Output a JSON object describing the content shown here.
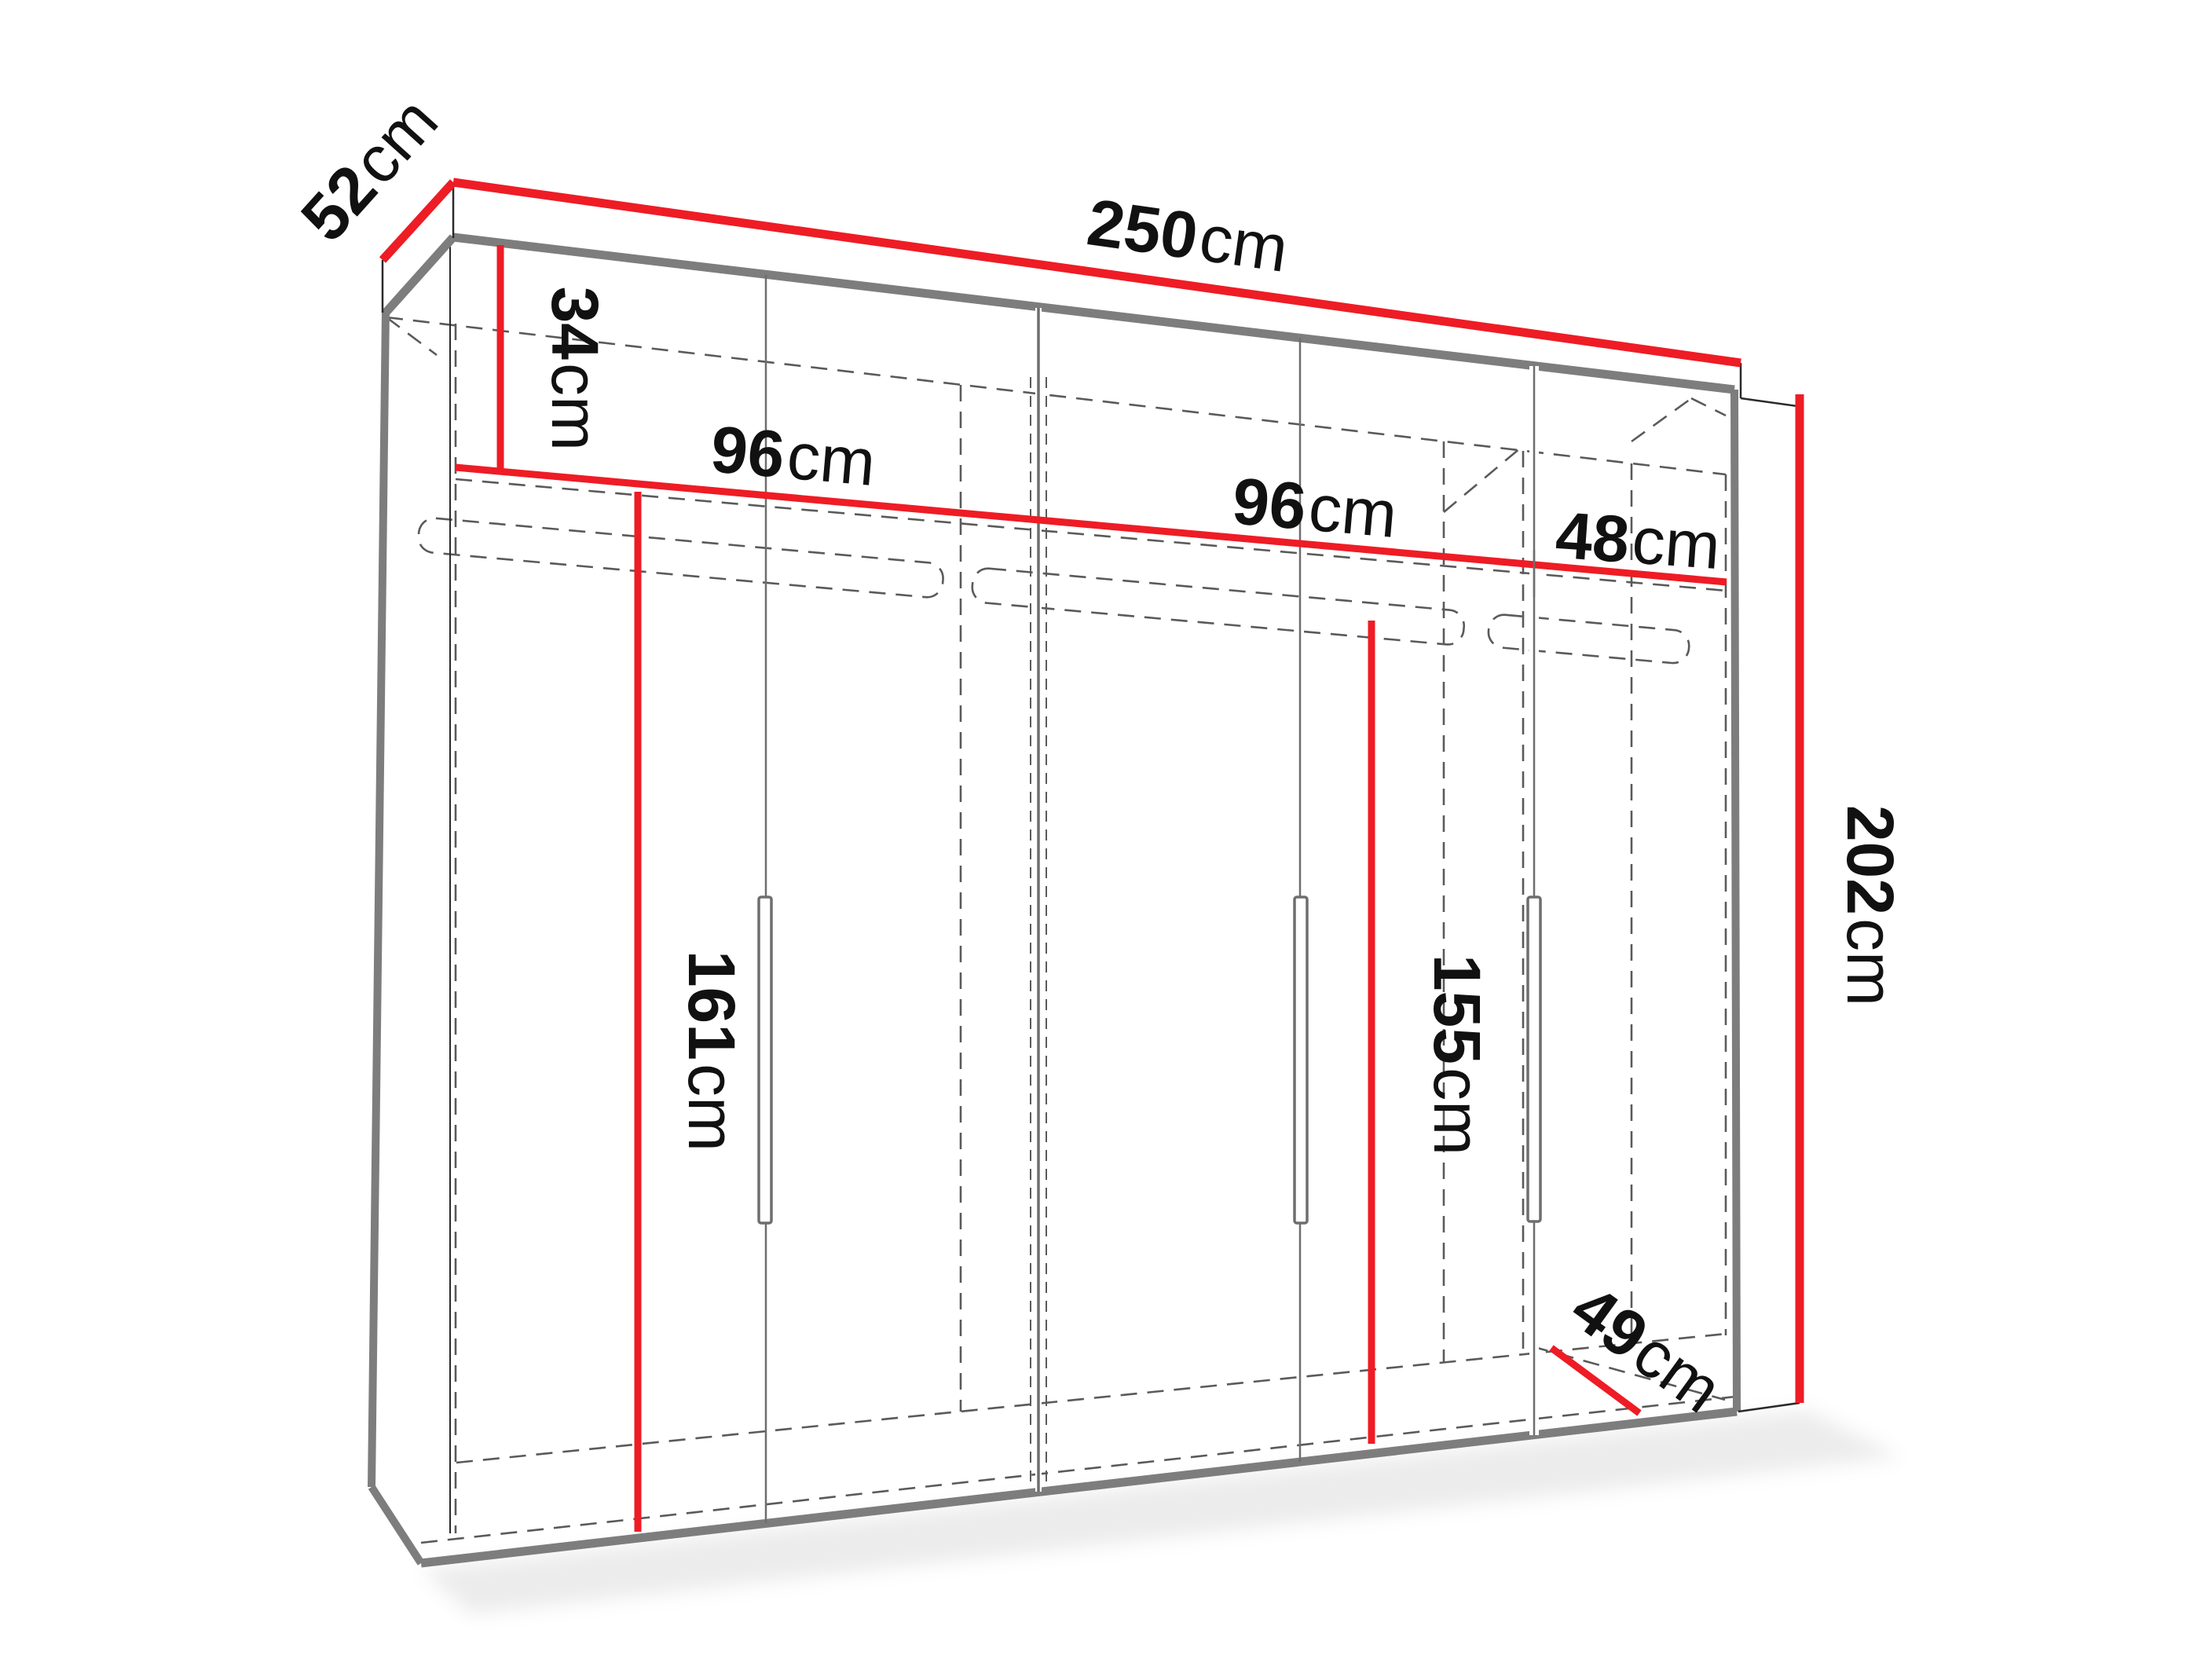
{
  "diagram": {
    "title": "wardrobe-dimension-drawing",
    "unit": "cm",
    "colors": {
      "dimension_line": "#ee1c25",
      "structure_edge": "#7d7d7d",
      "dashed_interior": "#5a5a5a",
      "label_text": "#111111",
      "background": "#ffffff"
    },
    "dims": {
      "width": {
        "v": "250",
        "u": "cm"
      },
      "depth": {
        "v": "52",
        "u": "cm"
      },
      "height": {
        "v": "202",
        "u": "cm"
      },
      "top_shelf": {
        "v": "34",
        "u": "cm"
      },
      "left_section": {
        "v": "96",
        "u": "cm"
      },
      "mid_section": {
        "v": "96",
        "u": "cm"
      },
      "right_section": {
        "v": "48",
        "u": "cm"
      },
      "left_height": {
        "v": "161",
        "u": "cm"
      },
      "mid_height": {
        "v": "155",
        "u": "cm"
      },
      "inner_depth": {
        "v": "49",
        "u": "cm"
      }
    }
  }
}
